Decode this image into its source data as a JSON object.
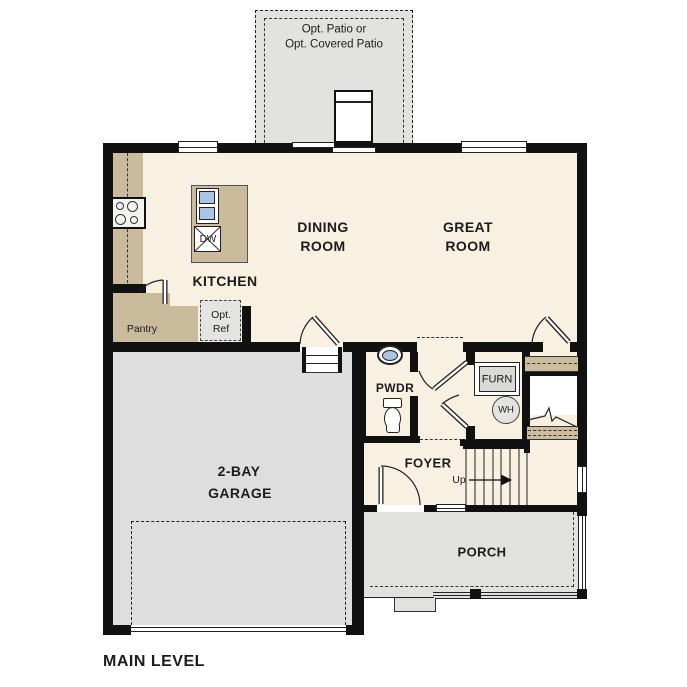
{
  "plan_title": "MAIN LEVEL",
  "patio": {
    "line1": "Opt. Patio or",
    "line2": "Opt. Covered Patio"
  },
  "rooms": {
    "dining": {
      "line1": "DINING",
      "line2": "ROOM"
    },
    "great": {
      "line1": "GREAT",
      "line2": "ROOM"
    },
    "kitchen": {
      "label": "KITCHEN"
    },
    "garage": {
      "line1": "2-BAY",
      "line2": "GARAGE"
    },
    "pwdr": {
      "label": "PWDR"
    },
    "foyer": {
      "label": "FOYER"
    },
    "porch": {
      "label": "PORCH"
    },
    "pantry": {
      "label": "Pantry"
    }
  },
  "fixtures": {
    "dishwasher": "DW",
    "furnace": "FURN",
    "water_heater": "WH",
    "opt_ref": {
      "line1": "Opt.",
      "line2": "Ref"
    }
  },
  "stairs": {
    "up_label": "Up"
  },
  "colors": {
    "floor": "#f8f0e1",
    "counter": "#c9bb9c",
    "garage_floor": "#dedede",
    "porch_floor": "#e1e1df",
    "patio": "#e2e2e0",
    "sink_blue": "#a9c6e5",
    "wall": "#111111"
  }
}
